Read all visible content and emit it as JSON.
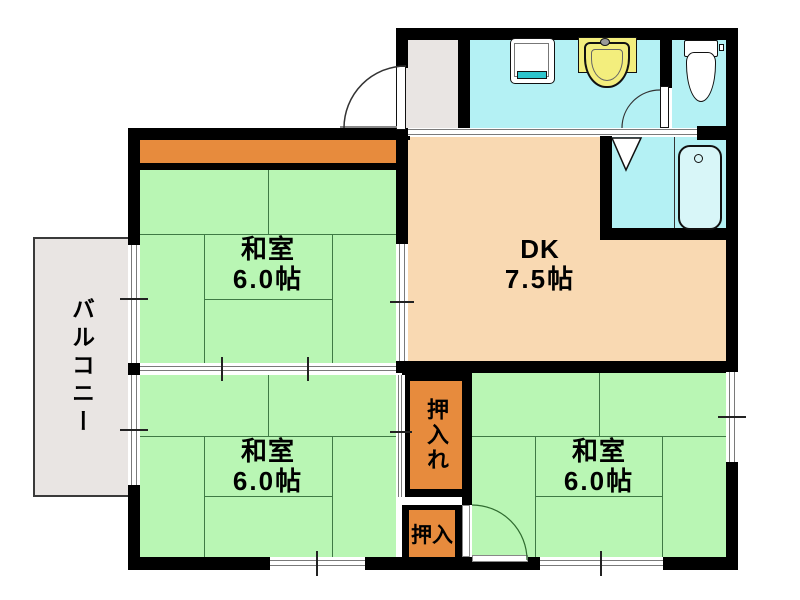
{
  "plan": {
    "balcony": {
      "label": "バルコニー"
    },
    "room_nw": {
      "name": "和室",
      "area": "6.0帖"
    },
    "room_sw": {
      "name": "和室",
      "area": "6.0帖"
    },
    "room_se": {
      "name": "和室",
      "area": "6.0帖"
    },
    "dk": {
      "name": "DK",
      "area": "7.5帖"
    },
    "closet_large": {
      "label": "押入れ"
    },
    "closet_small": {
      "label": "押入"
    },
    "fixtures": {
      "toilet": "toilet-icon",
      "washing_machine": "washing-machine-icon",
      "vanity_sink": "vanity-sink-icon",
      "bathtub": "bathtub-icon",
      "entry_door": "hinged-door-icon",
      "toilet_door": "hinged-door-icon",
      "bath_door": "folding-door-icon"
    },
    "colors": {
      "tatami": "#b9f6b4",
      "tatami_line": "#3f7a45",
      "dining_kitchen": "#f9d9b2",
      "closet": "#e78b3d",
      "water_area": "#b4f1f4",
      "balcony_floor": "#e9e5e3",
      "wall": "#000000",
      "vanity": "#f3ee7d",
      "washer_accent": "#2ec4cc"
    }
  }
}
